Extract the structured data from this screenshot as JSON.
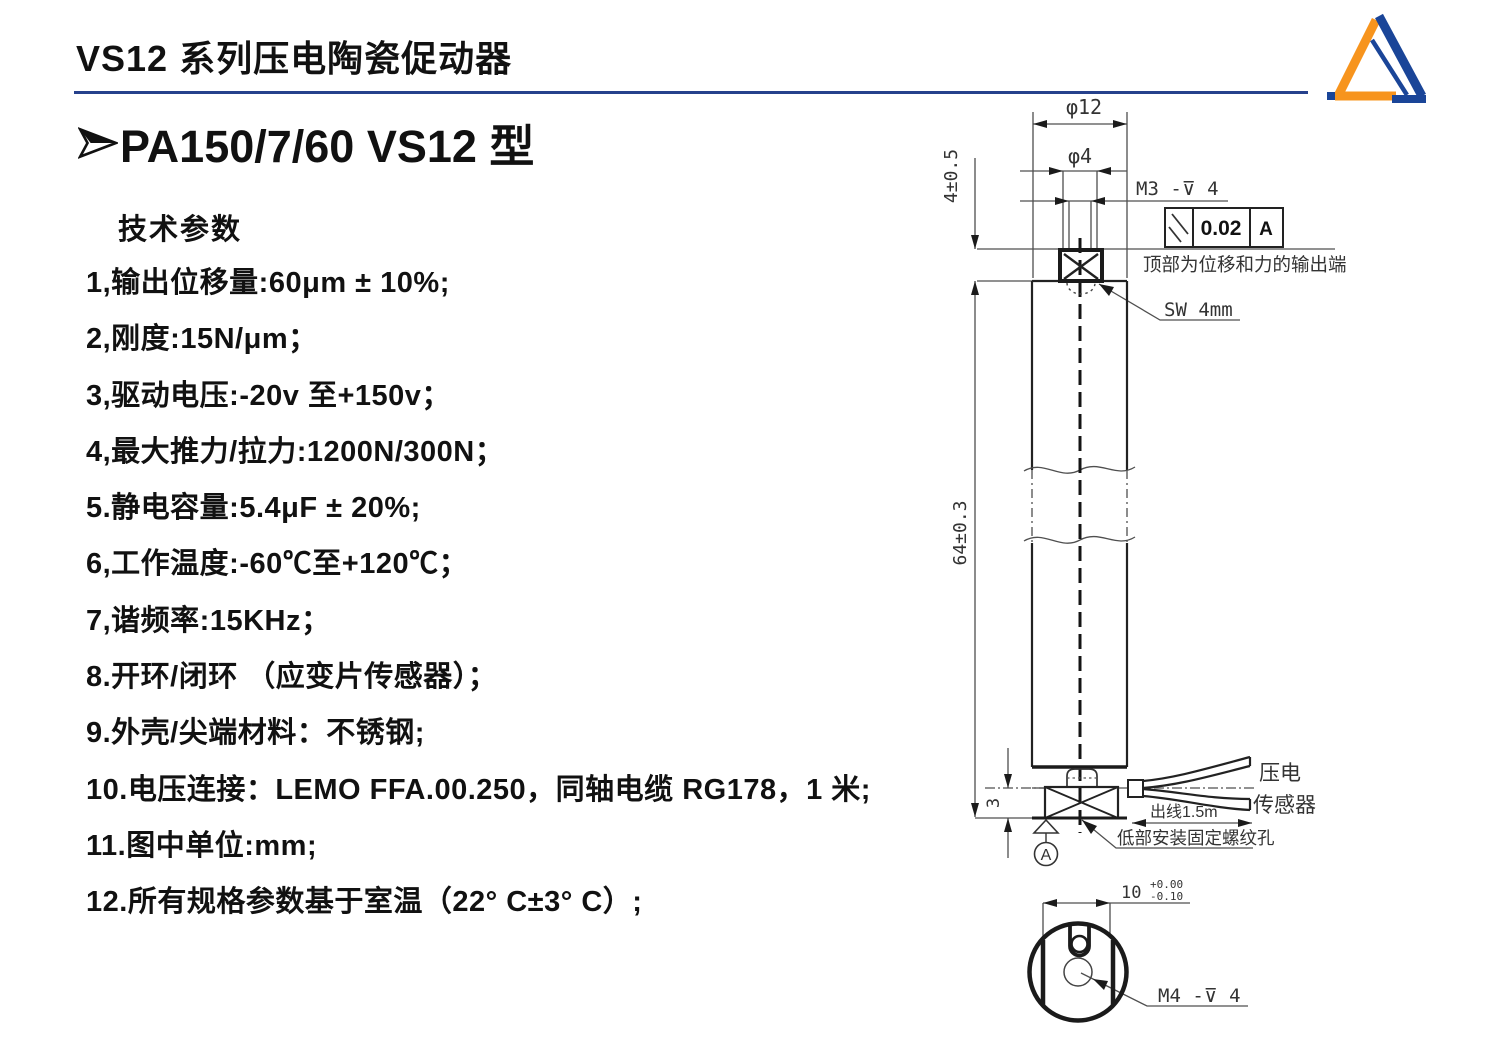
{
  "page": {
    "title": "VS12 系列压电陶瓷促动器",
    "model_heading": "PA150/7/60 VS12 型",
    "section_heading": "技术参数",
    "accent_line_color": "#26418C",
    "text_color": "#111111"
  },
  "logo": {
    "shape": "triangle-ribbon",
    "orange": "#F7941D",
    "blue": "#1A4598"
  },
  "icons": {
    "bullet": "➢",
    "fcf_symbol": "parallelism-slashes",
    "depth_symbol": "⊽"
  },
  "specs": {
    "items": [
      "1,输出位移量:60μm ± 10%;",
      "2,刚度:15N/μm；",
      "3,驱动电压:-20v 至+150v；",
      "4,最大推力/拉力:1200N/300N；",
      "5.静电容量:5.4μF ± 20%;",
      "6,工作温度:-60℃至+120℃；",
      "7,谐频率:15KHz；",
      "8.开环/闭环 （应变片传感器）；",
      "9.外壳/尖端材料：不锈钢;",
      "10.电压连接：LEMO FFA.00.250，同轴电缆 RG178，1 米;",
      "11.图中单位:mm;",
      "12.所有规格参数基于室温（22° C±3° C）;"
    ]
  },
  "drawing": {
    "stroke_color": "#222222",
    "dim_top_diameter": "φ12",
    "dim_tip_diameter": "φ4",
    "thread_top": "M3 -⊽ 4",
    "fcf_tolerance": "0.02",
    "fcf_datum": "A",
    "note_top_output": "顶部为位移和力的输出端",
    "wrench_size": "SW 4mm",
    "dim_tip_height": "4±0.5",
    "dim_body_height": "64±0.3",
    "dim_base_height": "3",
    "cable_length": "出线1.5m",
    "cable_label_line1": "压电",
    "cable_label_line2": "传感器",
    "note_bottom_mount": "低部安装固定螺纹孔",
    "datum_label": "A",
    "dim_across_flats": "10",
    "tolerance_upper": "+0.00",
    "tolerance_lower": "-0.10",
    "thread_bottom": "M4 -⊽ 4"
  }
}
